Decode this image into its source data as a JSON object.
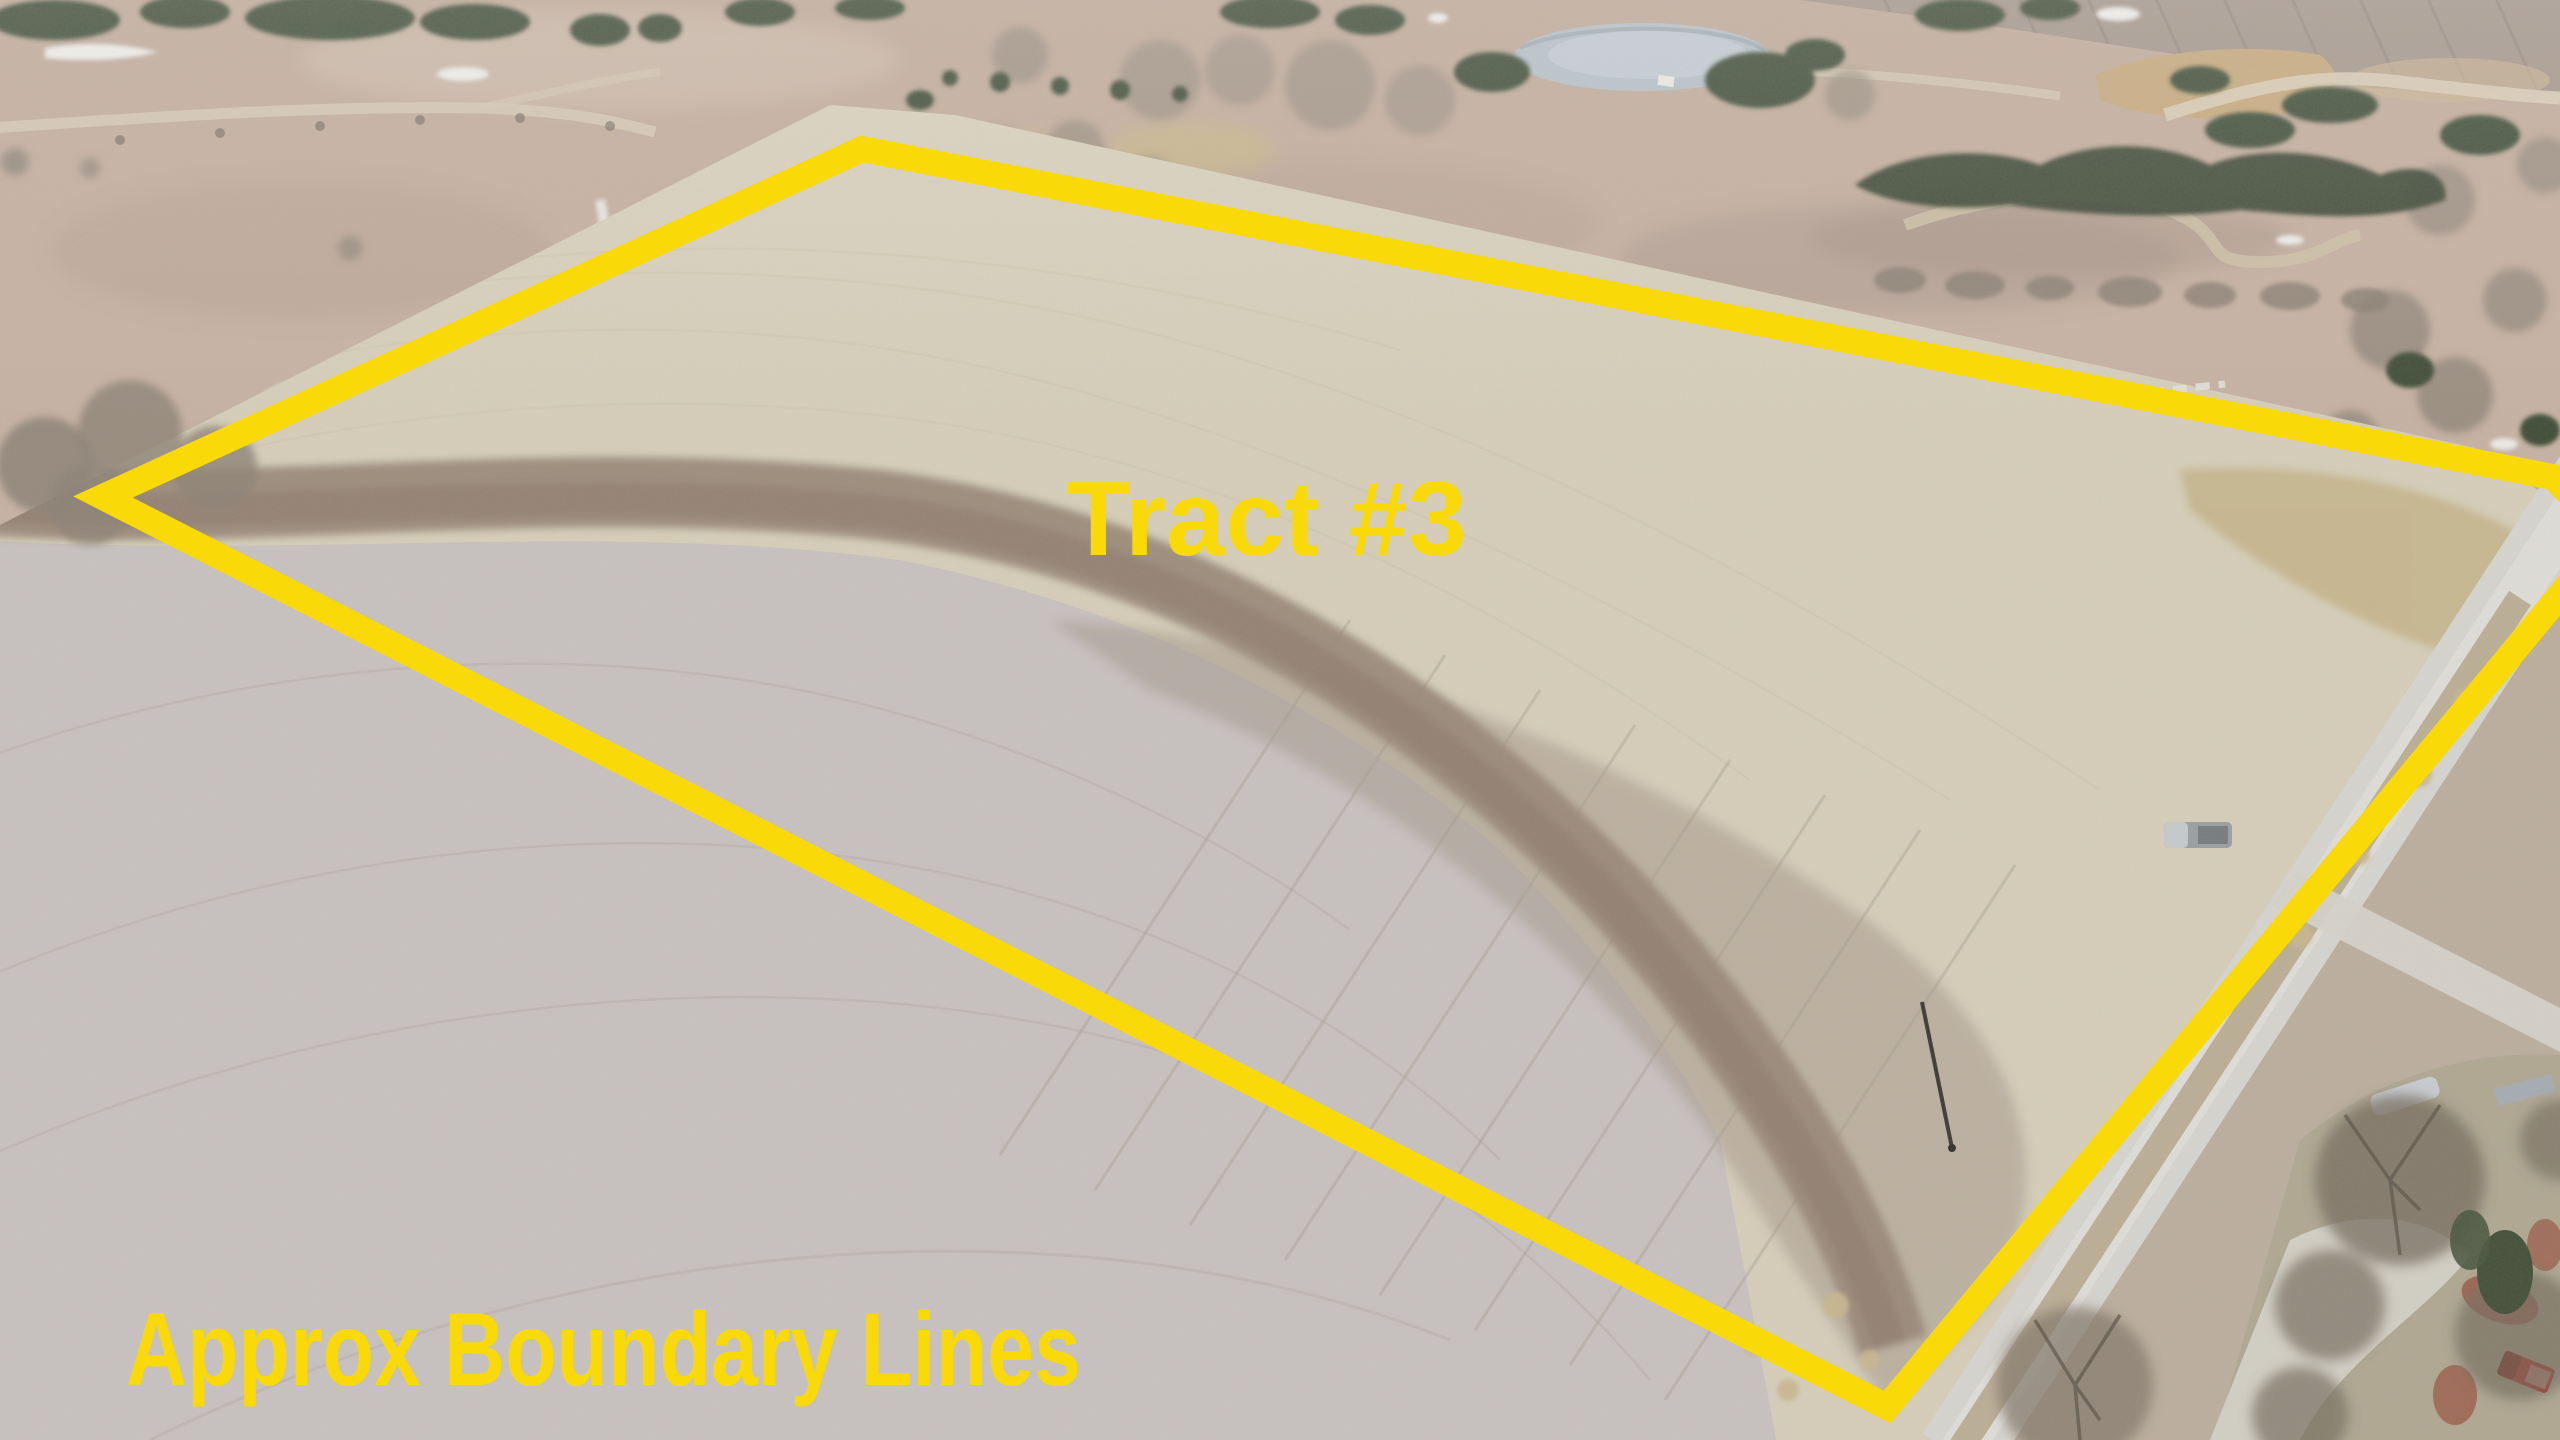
{
  "image": {
    "kind": "aerial-drone-photo",
    "scene": "Aerial view of a farmland auction tract: pale corn-stubble field with curved tillage bands, gravel road on the right, pastures with cedar trees, frozen pond and creek at top, farmstead with red pickup at bottom right"
  },
  "annotation": {
    "color": "#F9D908",
    "tract_label": "Tract #3",
    "caption": "Approx Boundary Lines",
    "boundary": {
      "stroke_width": 26,
      "closed": true,
      "points": [
        [
          103,
          497
        ],
        [
          862,
          149
        ],
        [
          2553,
          477
        ],
        [
          2610,
          535
        ],
        [
          1887,
          1407
        ]
      ]
    }
  }
}
